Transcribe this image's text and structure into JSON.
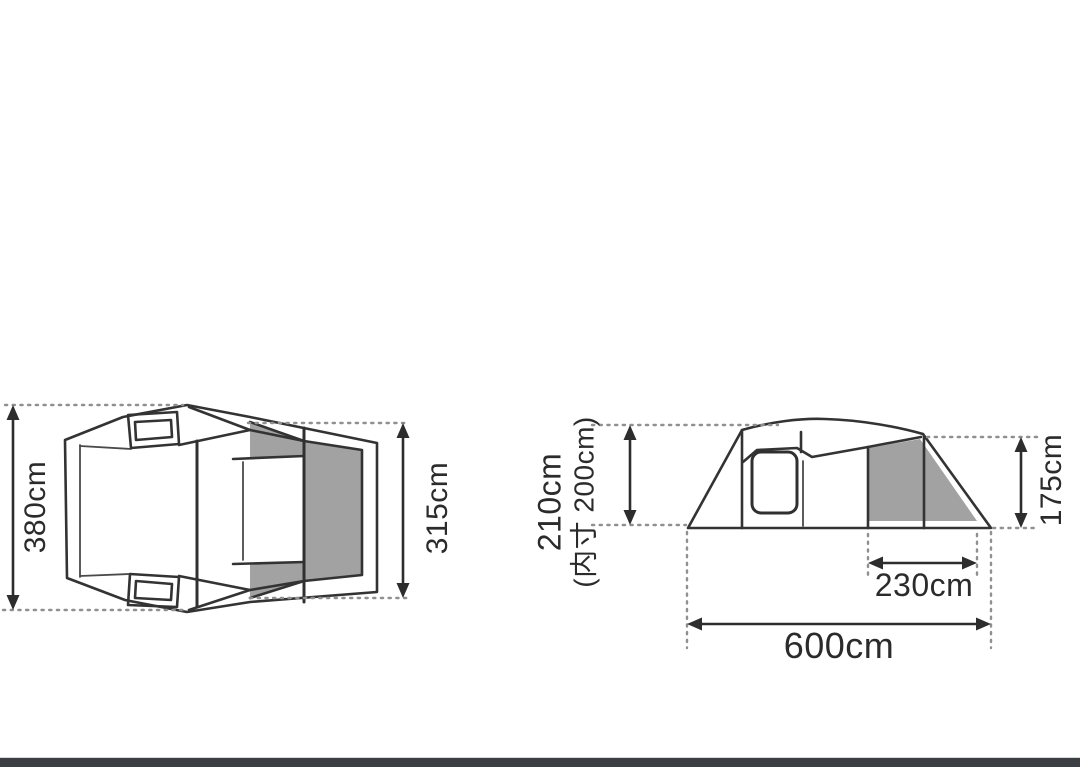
{
  "figure": {
    "description": "tent dimension diagram",
    "colors": {
      "line": "#333333",
      "shade_gray": "#a2a2a2",
      "dotted_gray": "#909090",
      "text": "#2b2b2b",
      "footer_bar": "#3b3e43",
      "background": "#ffffff"
    },
    "top_view": {
      "width_label": "380cm",
      "inner_room_width_label": "315cm"
    },
    "side_view": {
      "peak_height_label": "210cm",
      "inner_height_label": "(内寸 200cm)",
      "rear_height_label": "175cm",
      "inner_room_length_label": "230cm",
      "total_length_label": "600cm"
    }
  }
}
